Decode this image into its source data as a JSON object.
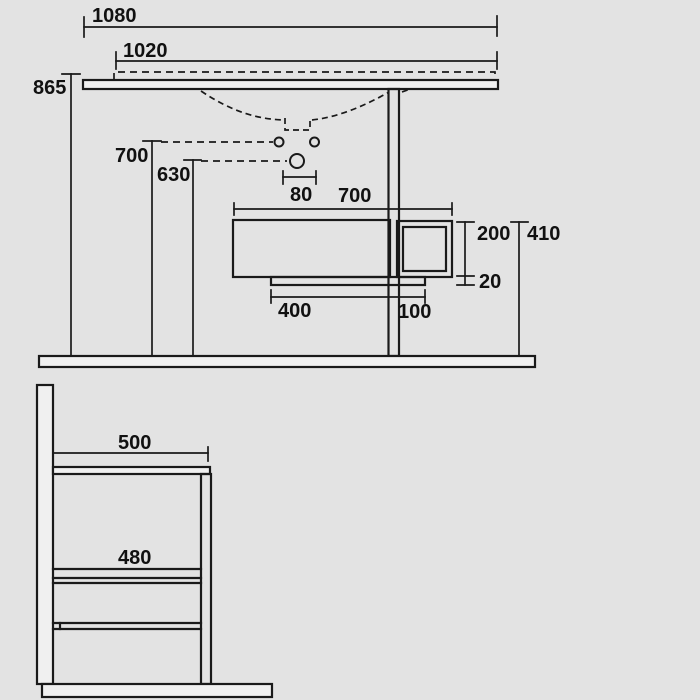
{
  "colors": {
    "background": "#e3e3e3",
    "line": "#1a1a1a",
    "fill_light": "#f0f0f0",
    "text": "#111111"
  },
  "front_view": {
    "dims": {
      "overall_width": "1080",
      "top_width": "1020",
      "overall_height": "865",
      "upper_holes_height": "700",
      "mixer_hole_height": "630",
      "hole_spacing": "80",
      "cabinet_width": "700",
      "side_box_height": "200",
      "plinth_gap": "20",
      "unit_total_height": "410",
      "plinth_width": "400",
      "side_box_width": "100"
    }
  },
  "side_view": {
    "dims": {
      "top_depth": "500",
      "cabinet_depth": "480"
    }
  }
}
